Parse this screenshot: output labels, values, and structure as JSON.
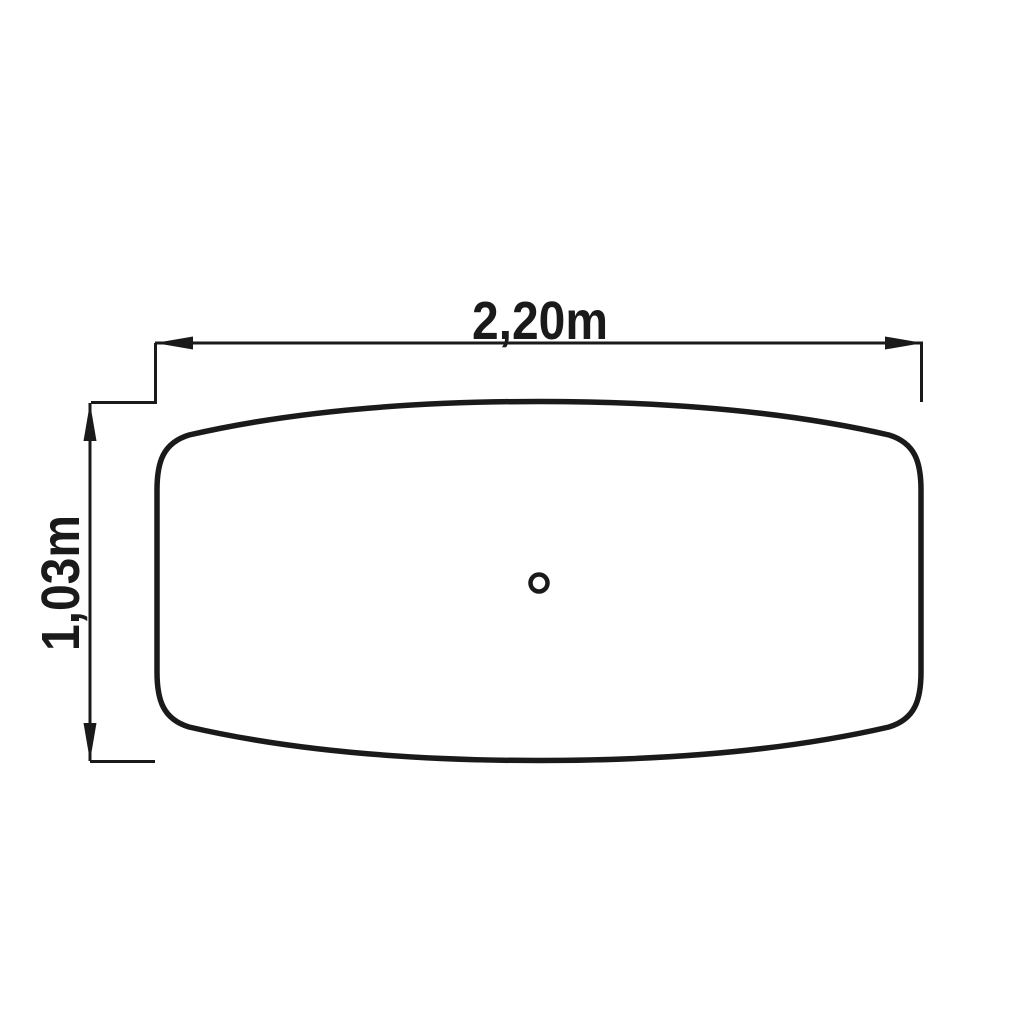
{
  "drawing": {
    "type": "technical-dimension-drawing",
    "subject": "tabletop-plan-view",
    "background_color": "#ffffff",
    "line_color": "#1a1a1a",
    "dimensions": {
      "width": {
        "label": "2,20m",
        "value_m": 2.2,
        "orientation": "horizontal"
      },
      "height": {
        "label": "1,03m",
        "value_m": 1.03,
        "orientation": "vertical"
      }
    },
    "features": {
      "center_hole": "small-circle-at-center"
    }
  }
}
